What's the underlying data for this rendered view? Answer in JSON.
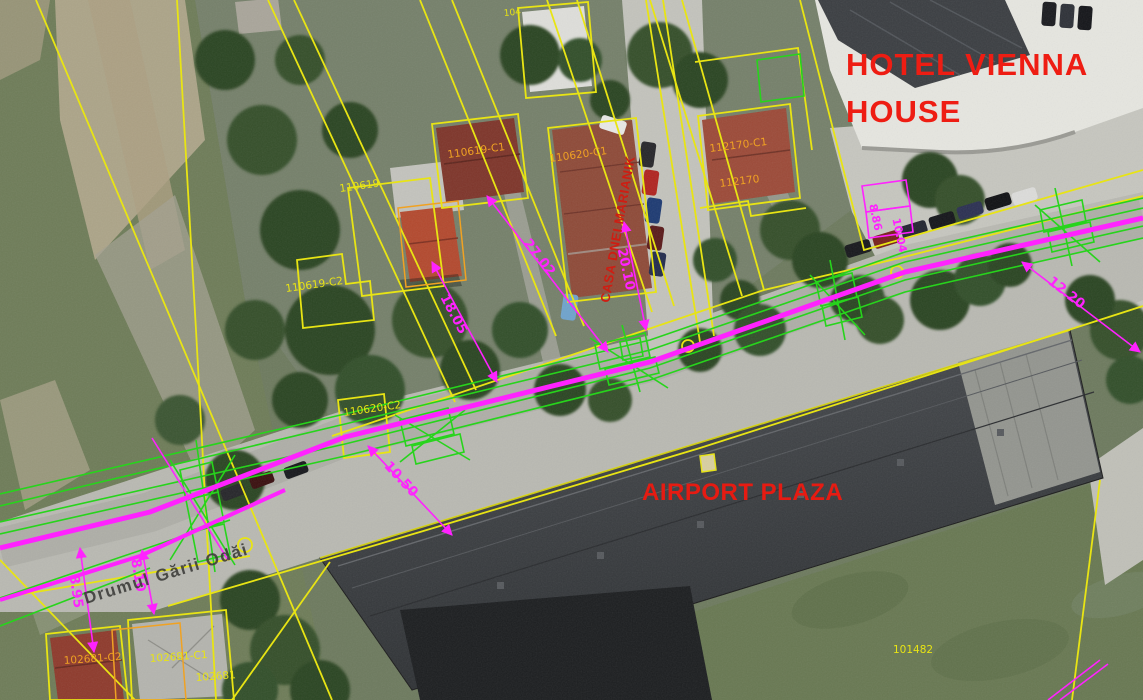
{
  "map": {
    "annotations": {
      "hotel_name_line1": "HOTEL VIENNA",
      "hotel_name_line2": "HOUSE",
      "building_label": "AIRPORT PLAZA",
      "house_label": "CASA DNEI MARIANIK",
      "street_name": "Drumul Gării Odăi"
    },
    "parcel_labels": [
      {
        "text": "104"
      },
      {
        "text": "110619"
      },
      {
        "text": "110619-C1"
      },
      {
        "text": "110620-C1"
      },
      {
        "text": "110619-C2"
      },
      {
        "text": "110620-C2"
      },
      {
        "text": "112170-C1"
      },
      {
        "text": "112170"
      },
      {
        "text": "102681-C2"
      },
      {
        "text": "102681-C1"
      },
      {
        "text": "102681"
      },
      {
        "text": "101482"
      }
    ],
    "dimensions": [
      {
        "value": "27.02"
      },
      {
        "value": "20.10"
      },
      {
        "value": "18.05"
      },
      {
        "value": "12.20"
      },
      {
        "value": "10.50"
      },
      {
        "value": "8.95"
      },
      {
        "value": "8.10"
      },
      {
        "value": "8.86"
      },
      {
        "value": "10.04"
      }
    ],
    "colors": {
      "parcel_boundary_yellow": "#e8e414",
      "roof_label_orange": "#f0a223",
      "survey_green": "#27d41c",
      "dimension_magenta": "#ff22ff",
      "annotation_red": "#ee1d13"
    }
  }
}
